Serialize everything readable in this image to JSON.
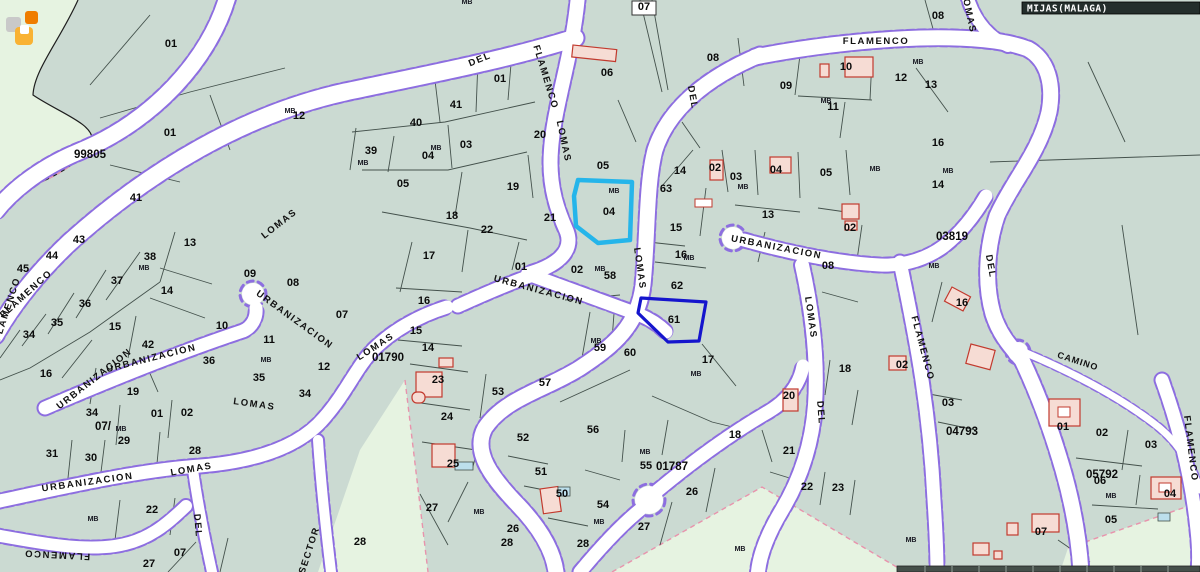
{
  "title_bar": {
    "text": "MIJAS(MALAGA)"
  },
  "map": {
    "background": "#cbdad2",
    "pale_area": "#e6f3e1",
    "street_fill": "#ffffff",
    "street_casing": "#8d6ee0",
    "parcel_line": "#3c4a44",
    "highlight_selected": "#25b5ea",
    "highlight_secondary": "#1515cd",
    "building_fill": "#f6dcd4",
    "building_stroke": "#c23a2e",
    "zone_code_color": "#8a3fe0",
    "camino_color": "#c22222",
    "logo_colors": {
      "gray": "#c9c9c9",
      "orange": "#ef7d00",
      "amber": "#f9b233"
    }
  },
  "labels": {
    "parcel_numbers": [
      {
        "t": "01",
        "x": 171,
        "y": 47
      },
      {
        "t": "12",
        "x": 299,
        "y": 119
      },
      {
        "t": "01",
        "x": 500,
        "y": 82
      },
      {
        "t": "40",
        "x": 416,
        "y": 126
      },
      {
        "t": "41",
        "x": 456,
        "y": 108
      },
      {
        "t": "39",
        "x": 371,
        "y": 154
      },
      {
        "t": "04",
        "x": 428,
        "y": 159
      },
      {
        "t": "03",
        "x": 466,
        "y": 148
      },
      {
        "t": "05",
        "x": 403,
        "y": 187
      },
      {
        "t": "20",
        "x": 540,
        "y": 138
      },
      {
        "t": "19",
        "x": 513,
        "y": 190
      },
      {
        "t": "18",
        "x": 452,
        "y": 219
      },
      {
        "t": "22",
        "x": 487,
        "y": 233
      },
      {
        "t": "17",
        "x": 429,
        "y": 259
      },
      {
        "t": "16",
        "x": 424,
        "y": 304
      },
      {
        "t": "21",
        "x": 550,
        "y": 221
      },
      {
        "t": "05",
        "x": 603,
        "y": 169
      },
      {
        "t": "04",
        "x": 609,
        "y": 215
      },
      {
        "t": "06",
        "x": 607,
        "y": 76
      },
      {
        "t": "07",
        "x": 644,
        "y": 10
      },
      {
        "t": "08",
        "x": 713,
        "y": 61
      },
      {
        "t": "09",
        "x": 786,
        "y": 89
      },
      {
        "t": "10",
        "x": 846,
        "y": 70
      },
      {
        "t": "11",
        "x": 833,
        "y": 110
      },
      {
        "t": "12",
        "x": 901,
        "y": 81
      },
      {
        "t": "13",
        "x": 931,
        "y": 88
      },
      {
        "t": "08",
        "x": 938,
        "y": 19
      },
      {
        "t": "63",
        "x": 666,
        "y": 192
      },
      {
        "t": "14",
        "x": 680,
        "y": 174
      },
      {
        "t": "02",
        "x": 715,
        "y": 171
      },
      {
        "t": "03",
        "x": 736,
        "y": 180
      },
      {
        "t": "04",
        "x": 776,
        "y": 173
      },
      {
        "t": "05",
        "x": 826,
        "y": 176
      },
      {
        "t": "02",
        "x": 850,
        "y": 231
      },
      {
        "t": "13",
        "x": 768,
        "y": 218
      },
      {
        "t": "15",
        "x": 676,
        "y": 231
      },
      {
        "t": "16",
        "x": 681,
        "y": 258
      },
      {
        "t": "62",
        "x": 677,
        "y": 289
      },
      {
        "t": "61",
        "x": 674,
        "y": 323
      },
      {
        "t": "60",
        "x": 630,
        "y": 356
      },
      {
        "t": "59",
        "x": 600,
        "y": 351
      },
      {
        "t": "58",
        "x": 610,
        "y": 279
      },
      {
        "t": "02",
        "x": 577,
        "y": 273
      },
      {
        "t": "01",
        "x": 521,
        "y": 270
      },
      {
        "t": "17",
        "x": 708,
        "y": 363
      },
      {
        "t": "16",
        "x": 938,
        "y": 146
      },
      {
        "t": "14",
        "x": 938,
        "y": 188
      },
      {
        "t": "07",
        "x": 342,
        "y": 318
      },
      {
        "t": "08",
        "x": 293,
        "y": 286
      },
      {
        "t": "09",
        "x": 250,
        "y": 277
      },
      {
        "t": "10",
        "x": 222,
        "y": 329
      },
      {
        "t": "11",
        "x": 269,
        "y": 343
      },
      {
        "t": "36",
        "x": 209,
        "y": 364
      },
      {
        "t": "35",
        "x": 259,
        "y": 381
      },
      {
        "t": "12",
        "x": 324,
        "y": 370
      },
      {
        "t": "34",
        "x": 305,
        "y": 397
      },
      {
        "t": "02",
        "x": 187,
        "y": 416
      },
      {
        "t": "13",
        "x": 190,
        "y": 246
      },
      {
        "t": "14",
        "x": 167,
        "y": 294
      },
      {
        "t": "38",
        "x": 150,
        "y": 260
      },
      {
        "t": "37",
        "x": 117,
        "y": 284
      },
      {
        "t": "36",
        "x": 85,
        "y": 307
      },
      {
        "t": "35",
        "x": 57,
        "y": 326
      },
      {
        "t": "34",
        "x": 29,
        "y": 338
      },
      {
        "t": "15",
        "x": 115,
        "y": 330
      },
      {
        "t": "42",
        "x": 148,
        "y": 348
      },
      {
        "t": "16",
        "x": 46,
        "y": 377
      },
      {
        "t": "19",
        "x": 133,
        "y": 395
      },
      {
        "t": "43",
        "x": 79,
        "y": 243
      },
      {
        "t": "44",
        "x": 52,
        "y": 259
      },
      {
        "t": "45",
        "x": 23,
        "y": 272
      },
      {
        "t": "41",
        "x": 136,
        "y": 201
      },
      {
        "t": "01",
        "x": 170,
        "y": 136
      },
      {
        "t": "34",
        "x": 92,
        "y": 416
      },
      {
        "t": "01",
        "x": 157,
        "y": 417
      },
      {
        "t": "29",
        "x": 124,
        "y": 444
      },
      {
        "t": "31",
        "x": 52,
        "y": 457
      },
      {
        "t": "30",
        "x": 91,
        "y": 461
      },
      {
        "t": "28",
        "x": 195,
        "y": 454
      },
      {
        "t": "22",
        "x": 152,
        "y": 513
      },
      {
        "t": "07",
        "x": 180,
        "y": 556
      },
      {
        "t": "27",
        "x": 149,
        "y": 567
      },
      {
        "t": "28",
        "x": 360,
        "y": 545
      },
      {
        "t": "28",
        "x": 507,
        "y": 546
      },
      {
        "t": "15",
        "x": 416,
        "y": 334
      },
      {
        "t": "14",
        "x": 428,
        "y": 351
      },
      {
        "t": "23",
        "x": 438,
        "y": 383
      },
      {
        "t": "24",
        "x": 447,
        "y": 420
      },
      {
        "t": "53",
        "x": 498,
        "y": 395
      },
      {
        "t": "52",
        "x": 523,
        "y": 441
      },
      {
        "t": "51",
        "x": 541,
        "y": 475
      },
      {
        "t": "50",
        "x": 562,
        "y": 497
      },
      {
        "t": "25",
        "x": 453,
        "y": 467
      },
      {
        "t": "27",
        "x": 432,
        "y": 511
      },
      {
        "t": "26",
        "x": 513,
        "y": 532
      },
      {
        "t": "54",
        "x": 603,
        "y": 508
      },
      {
        "t": "56",
        "x": 593,
        "y": 433
      },
      {
        "t": "55",
        "x": 646,
        "y": 469
      },
      {
        "t": "57",
        "x": 545,
        "y": 386
      },
      {
        "t": "18",
        "x": 735,
        "y": 438
      },
      {
        "t": "21",
        "x": 789,
        "y": 454
      },
      {
        "t": "26",
        "x": 692,
        "y": 495
      },
      {
        "t": "27",
        "x": 644,
        "y": 530
      },
      {
        "t": "28",
        "x": 583,
        "y": 547
      },
      {
        "t": "18",
        "x": 845,
        "y": 372
      },
      {
        "t": "20",
        "x": 789,
        "y": 399
      },
      {
        "t": "22",
        "x": 807,
        "y": 490
      },
      {
        "t": "23",
        "x": 838,
        "y": 491
      },
      {
        "t": "08",
        "x": 828,
        "y": 269
      },
      {
        "t": "16",
        "x": 962,
        "y": 306
      },
      {
        "t": "02",
        "x": 902,
        "y": 368
      },
      {
        "t": "03",
        "x": 948,
        "y": 406
      },
      {
        "t": "01",
        "x": 1063,
        "y": 430
      },
      {
        "t": "02",
        "x": 1102,
        "y": 436
      },
      {
        "t": "03",
        "x": 1151,
        "y": 448
      },
      {
        "t": "06",
        "x": 1100,
        "y": 484
      },
      {
        "t": "04",
        "x": 1170,
        "y": 497
      },
      {
        "t": "05",
        "x": 1111,
        "y": 523
      },
      {
        "t": "07",
        "x": 1041,
        "y": 535
      }
    ],
    "mb_labels": [
      {
        "t": "MB",
        "x": 290,
        "y": 113
      },
      {
        "t": "MB",
        "x": 363,
        "y": 165
      },
      {
        "t": "MB",
        "x": 436,
        "y": 150
      },
      {
        "t": "MB",
        "x": 614,
        "y": 193
      },
      {
        "t": "MB",
        "x": 826,
        "y": 103
      },
      {
        "t": "MB",
        "x": 918,
        "y": 64
      },
      {
        "t": "MB",
        "x": 144,
        "y": 270
      },
      {
        "t": "MB",
        "x": 266,
        "y": 362
      },
      {
        "t": "MB",
        "x": 596,
        "y": 343
      },
      {
        "t": "MB",
        "x": 600,
        "y": 271
      },
      {
        "t": "MB",
        "x": 689,
        "y": 260
      },
      {
        "t": "MB",
        "x": 743,
        "y": 189
      },
      {
        "t": "MB",
        "x": 696,
        "y": 376
      },
      {
        "t": "MB",
        "x": 948,
        "y": 173
      },
      {
        "t": "MB",
        "x": 875,
        "y": 171
      },
      {
        "t": "MB",
        "x": 934,
        "y": 268
      },
      {
        "t": "MB",
        "x": 121,
        "y": 431
      },
      {
        "t": "MB",
        "x": 93,
        "y": 521
      },
      {
        "t": "MB",
        "x": 479,
        "y": 514
      },
      {
        "t": "MB",
        "x": 599,
        "y": 524
      },
      {
        "t": "MB",
        "x": 645,
        "y": 454
      },
      {
        "t": "MB",
        "x": 740,
        "y": 551
      },
      {
        "t": "MB",
        "x": 911,
        "y": 542
      },
      {
        "t": "MB",
        "x": 467,
        "y": 4
      },
      {
        "t": "MB",
        "x": 1111,
        "y": 498
      }
    ],
    "street_names": [
      {
        "t": "FLAMENCO",
        "x": 876,
        "y": 44,
        "r": 0
      },
      {
        "t": "LOMAS",
        "x": 966,
        "y": 13,
        "r": 78
      },
      {
        "t": "DEL",
        "x": 690,
        "y": 98,
        "r": 80
      },
      {
        "t": "DEL",
        "x": 481,
        "y": 62,
        "r": -22
      },
      {
        "t": "FLAMENCO",
        "x": 543,
        "y": 78,
        "r": 73
      },
      {
        "t": "LOMAS",
        "x": 561,
        "y": 142,
        "r": 78
      },
      {
        "t": "LOMAS",
        "x": 637,
        "y": 269,
        "r": 82
      },
      {
        "t": "URBANIZACION",
        "x": 538,
        "y": 293,
        "r": 15
      },
      {
        "t": "URBANIZACION",
        "x": 776,
        "y": 250,
        "r": 11
      },
      {
        "t": "LOMAS",
        "x": 808,
        "y": 318,
        "r": 82
      },
      {
        "t": "DEL",
        "x": 818,
        "y": 413,
        "r": 86
      },
      {
        "t": "FLAMENCO",
        "x": 920,
        "y": 349,
        "r": 75
      },
      {
        "t": "DEL",
        "x": 988,
        "y": 267,
        "r": 80
      },
      {
        "t": "FLAMENCO",
        "x": 1188,
        "y": 449,
        "r": 83
      },
      {
        "t": "LOMAS",
        "x": 281,
        "y": 226,
        "r": -38
      },
      {
        "t": "FLAMENCO",
        "x": 28,
        "y": 296,
        "r": -42
      },
      {
        "t": "URBANIZACION",
        "x": 293,
        "y": 322,
        "r": 36
      },
      {
        "t": "URBANIZACION",
        "x": 152,
        "y": 361,
        "r": -14
      },
      {
        "t": "URBANIZACION",
        "x": 96,
        "y": 381,
        "r": -38
      },
      {
        "t": "LOMAS",
        "x": 254,
        "y": 407,
        "r": 8
      },
      {
        "t": "URBANIZACION",
        "x": 88,
        "y": 485,
        "r": -8
      },
      {
        "t": "LOMAS",
        "x": 192,
        "y": 472,
        "r": -10
      },
      {
        "t": "FLAMENCO",
        "x": 10,
        "y": 310,
        "r": -72
      },
      {
        "t": "FLAMENCO",
        "x": 57,
        "y": 552,
        "r": 183
      },
      {
        "t": "DEL",
        "x": 195,
        "y": 526,
        "r": 85
      },
      {
        "t": "SECTOR",
        "x": 312,
        "y": 551,
        "r": -72
      },
      {
        "t": "LOMAS",
        "x": 377,
        "y": 349,
        "r": -33
      },
      {
        "t": "CAMINO",
        "x": 1077,
        "y": 364,
        "r": 18,
        "cls": "cam",
        "c": "#c22222"
      }
    ],
    "zone_codes": [
      {
        "t": "99805",
        "x": 90,
        "y": 158,
        "c": "#b44ae0"
      },
      {
        "t": "03819",
        "x": 952,
        "y": 240,
        "c": "#8a3fe0"
      },
      {
        "t": "01790",
        "x": 388,
        "y": 361,
        "c": "#7a3df0"
      },
      {
        "t": "01787",
        "x": 672,
        "y": 470,
        "c": "#6a35e8"
      },
      {
        "t": "04793",
        "x": 962,
        "y": 435,
        "c": "#8a3fe0"
      },
      {
        "t": "05792",
        "x": 1102,
        "y": 478,
        "c": "#8a3fe0"
      },
      {
        "t": "07/",
        "x": 103,
        "y": 430,
        "c": "#9040d8"
      }
    ]
  }
}
